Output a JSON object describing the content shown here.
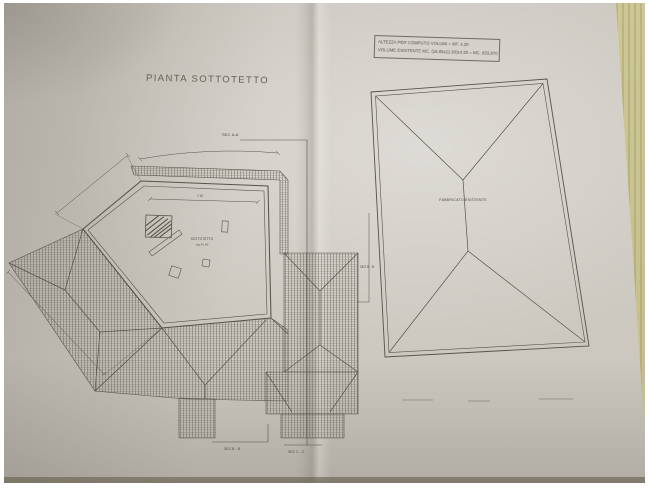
{
  "photo": {
    "paper_color": "#ccc8c0",
    "desk_color": "#c6c08d",
    "line_color": "#5b574e"
  },
  "title": "PIANTA SOTTOTETTO",
  "info_box": {
    "line1": "ALTEZZA PER COMPUTO VOLUMI = MT. 4,30",
    "line2": "VOLUME ESISTENTE MC. (16.85x11.50)x4.30 = MC. 833,870"
  },
  "left_plan": {
    "room_label": "SOTTOTETTO",
    "room_area": "mq 41.40",
    "dim_top": "7.10",
    "section_top": "SEZ. A-A",
    "section_bottom_left": "SEZ B - B",
    "section_bottom_right": "SEZ C - C"
  },
  "right_plan": {
    "label": "FABBRICATO ESISTENTE",
    "section_left": "SEZ B - B"
  }
}
